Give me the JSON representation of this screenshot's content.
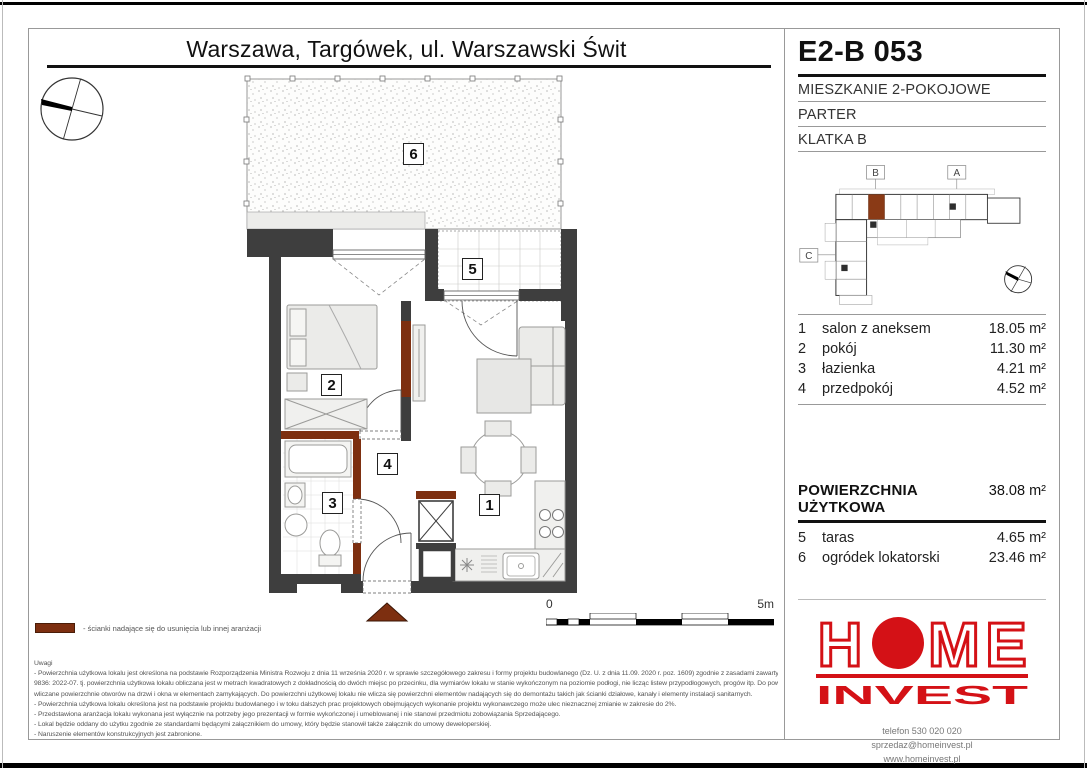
{
  "header": {
    "location_title": "Warszawa, Targówek, ul. Warszawski Świt",
    "unit_code": "E2-B 053",
    "unit_type": "MIESZKANIE 2-POKOJOWE",
    "floor_level": "PARTER",
    "staircase": "KLATKA B"
  },
  "minimap": {
    "markers": [
      "B",
      "A",
      "C"
    ]
  },
  "rooms": [
    {
      "no": "1",
      "name": "salon z aneksem",
      "area": "18.05 m²"
    },
    {
      "no": "2",
      "name": "pokój",
      "area": "11.30 m²"
    },
    {
      "no": "3",
      "name": "łazienka",
      "area": "4.21 m²"
    },
    {
      "no": "4",
      "name": "przedpokój",
      "area": "4.52 m²"
    }
  ],
  "usable_area": {
    "label": "POWIERZCHNIA UŻYTKOWA",
    "value": "38.08 m²"
  },
  "outdoor": [
    {
      "no": "5",
      "name": "taras",
      "area": "4.65 m²"
    },
    {
      "no": "6",
      "name": "ogródek lokatorski",
      "area": "23.46 m²"
    }
  ],
  "plan": {
    "room_labels": {
      "r1": "1",
      "r2": "2",
      "r3": "3",
      "r4": "4",
      "r5": "5",
      "r6": "6"
    }
  },
  "scale": {
    "start": "0",
    "end": "5m"
  },
  "legend": {
    "color": "#7d2f10",
    "text": "- ścianki nadające się do usunięcia lub innej aranżacji"
  },
  "notes": {
    "title": "Uwagi",
    "lines": [
      "- Powierzchnia użytkowa lokalu jest określona na podstawie Rozporządzenia Ministra Rozwoju z dnia 11 września 2020 r. w sprawie szczegółowego zakresu i formy projektu budowlanego (Dz. U. z dnia 11.09. 2020 r. poz. 1609) zgodnie z zasadami zawartymi w Polskiej Normie PN-ISO",
      "9836: 2022-07. tj. powierzchnia użytkowa lokalu obliczana jest w metrach kwadratowych z dokładnością do dwóch miejsc po przecinku, dla wymiarów lokalu w stanie wykończonym na poziomie podłogi, nie licząc listew przypodłogowych, progów itp. Do powierzchni użytkowej lokalu nie są",
      "wliczane powierzchnie otworów na drzwi i okna w elementach zamykających. Do powierzchni użytkowej lokalu nie wlicza się powierzchni elementów nadających się do demontażu takich jak ścianki działowe, kanały i elementy instalacji sanitarnych.",
      "- Powierzchnia użytkowa lokalu określona jest na podstawie projektu budowlanego i w toku dalszych prac projektowych obejmujących wykonanie projektu wykonawczego może ulec nieznacznej zmianie w zakresie do 2%.",
      "- Przedstawiona aranżacja lokalu wykonana jest wyłącznie na potrzeby jego prezentacji w formie wykończonej i umeblowanej i nie stanowi przedmiotu zobowiązania Sprzedającego.",
      "- Lokal będzie oddany do użytku zgodnie ze standardami będącymi załącznikiem do umowy, który będzie stanowił także załącznik do umowy deweloperskiej.",
      "- Naruszenie elementów konstrukcyjnych jest zabronione."
    ]
  },
  "footer": {
    "brand_letters": [
      "H",
      "O",
      "M",
      "E"
    ],
    "brand_bottom": "INVEST",
    "brand_color": "#d41116",
    "phone": "telefon 530 020 020",
    "email": "sprzedaz@homeinvest.pl",
    "website": "www.homeinvest.pl"
  },
  "colors": {
    "wall": "#3e3e3e",
    "removable_wall": "#7d2f10",
    "frame": "#999999"
  }
}
